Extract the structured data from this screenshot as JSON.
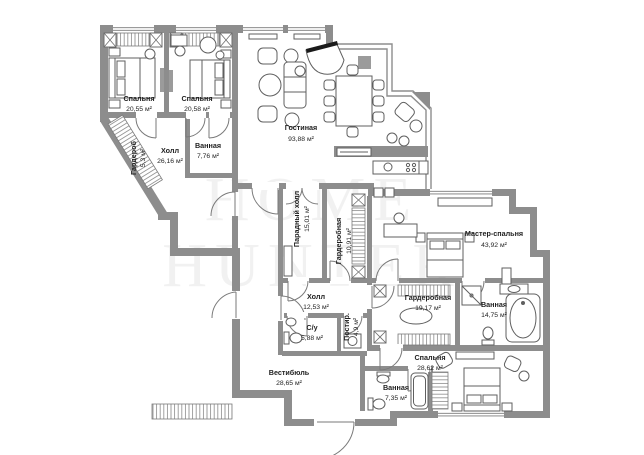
{
  "image": {
    "type": "apartment-floor-plan",
    "language": "ru"
  },
  "watermark": {
    "line1": "HOME",
    "line2": "HUNTER"
  },
  "palette": {
    "wall": "#8d8d8d",
    "furniture": "#5f5f5f",
    "label": "#1f1f1f",
    "background": "#ffffff"
  },
  "rooms": [
    {
      "id": "bedroom-1",
      "name": "Спальня",
      "area": "20,55 м²"
    },
    {
      "id": "bedroom-2",
      "name": "Спальня",
      "area": "20,58 м²"
    },
    {
      "id": "living-room",
      "name": "Гостиная",
      "area": "93,88 м²"
    },
    {
      "id": "hall",
      "name": "Холл",
      "area": "26,16 м²"
    },
    {
      "id": "closet",
      "name": "Гардероб",
      "area": "5,3 м²"
    },
    {
      "id": "bathroom-1",
      "name": "Ванная",
      "area": "7,76 м²"
    },
    {
      "id": "grand-hall",
      "name": "Парадный холл",
      "area": "15,01 м²"
    },
    {
      "id": "dressing-1",
      "name": "Гардеробная",
      "area": "10,91 м²"
    },
    {
      "id": "master-bedroom",
      "name": "Мастер-спальня",
      "area": "43,92 м²"
    },
    {
      "id": "dressing-2",
      "name": "Гардеробная",
      "area": "19,17 м²"
    },
    {
      "id": "bathroom-2",
      "name": "Ванная",
      "area": "14,75 м²"
    },
    {
      "id": "hall-2",
      "name": "Холл",
      "area": "12,53 м²"
    },
    {
      "id": "wc",
      "name": "С/у",
      "area": "5,88 м²"
    },
    {
      "id": "laundry",
      "name": "Постир.",
      "area": "4,9 м²"
    },
    {
      "id": "bedroom-3",
      "name": "Спальня",
      "area": "28,62 м²"
    },
    {
      "id": "bathroom-3",
      "name": "Ванная",
      "area": "7,35 м²"
    },
    {
      "id": "vestibule",
      "name": "Вестибюль",
      "area": "28,65 м²"
    }
  ]
}
